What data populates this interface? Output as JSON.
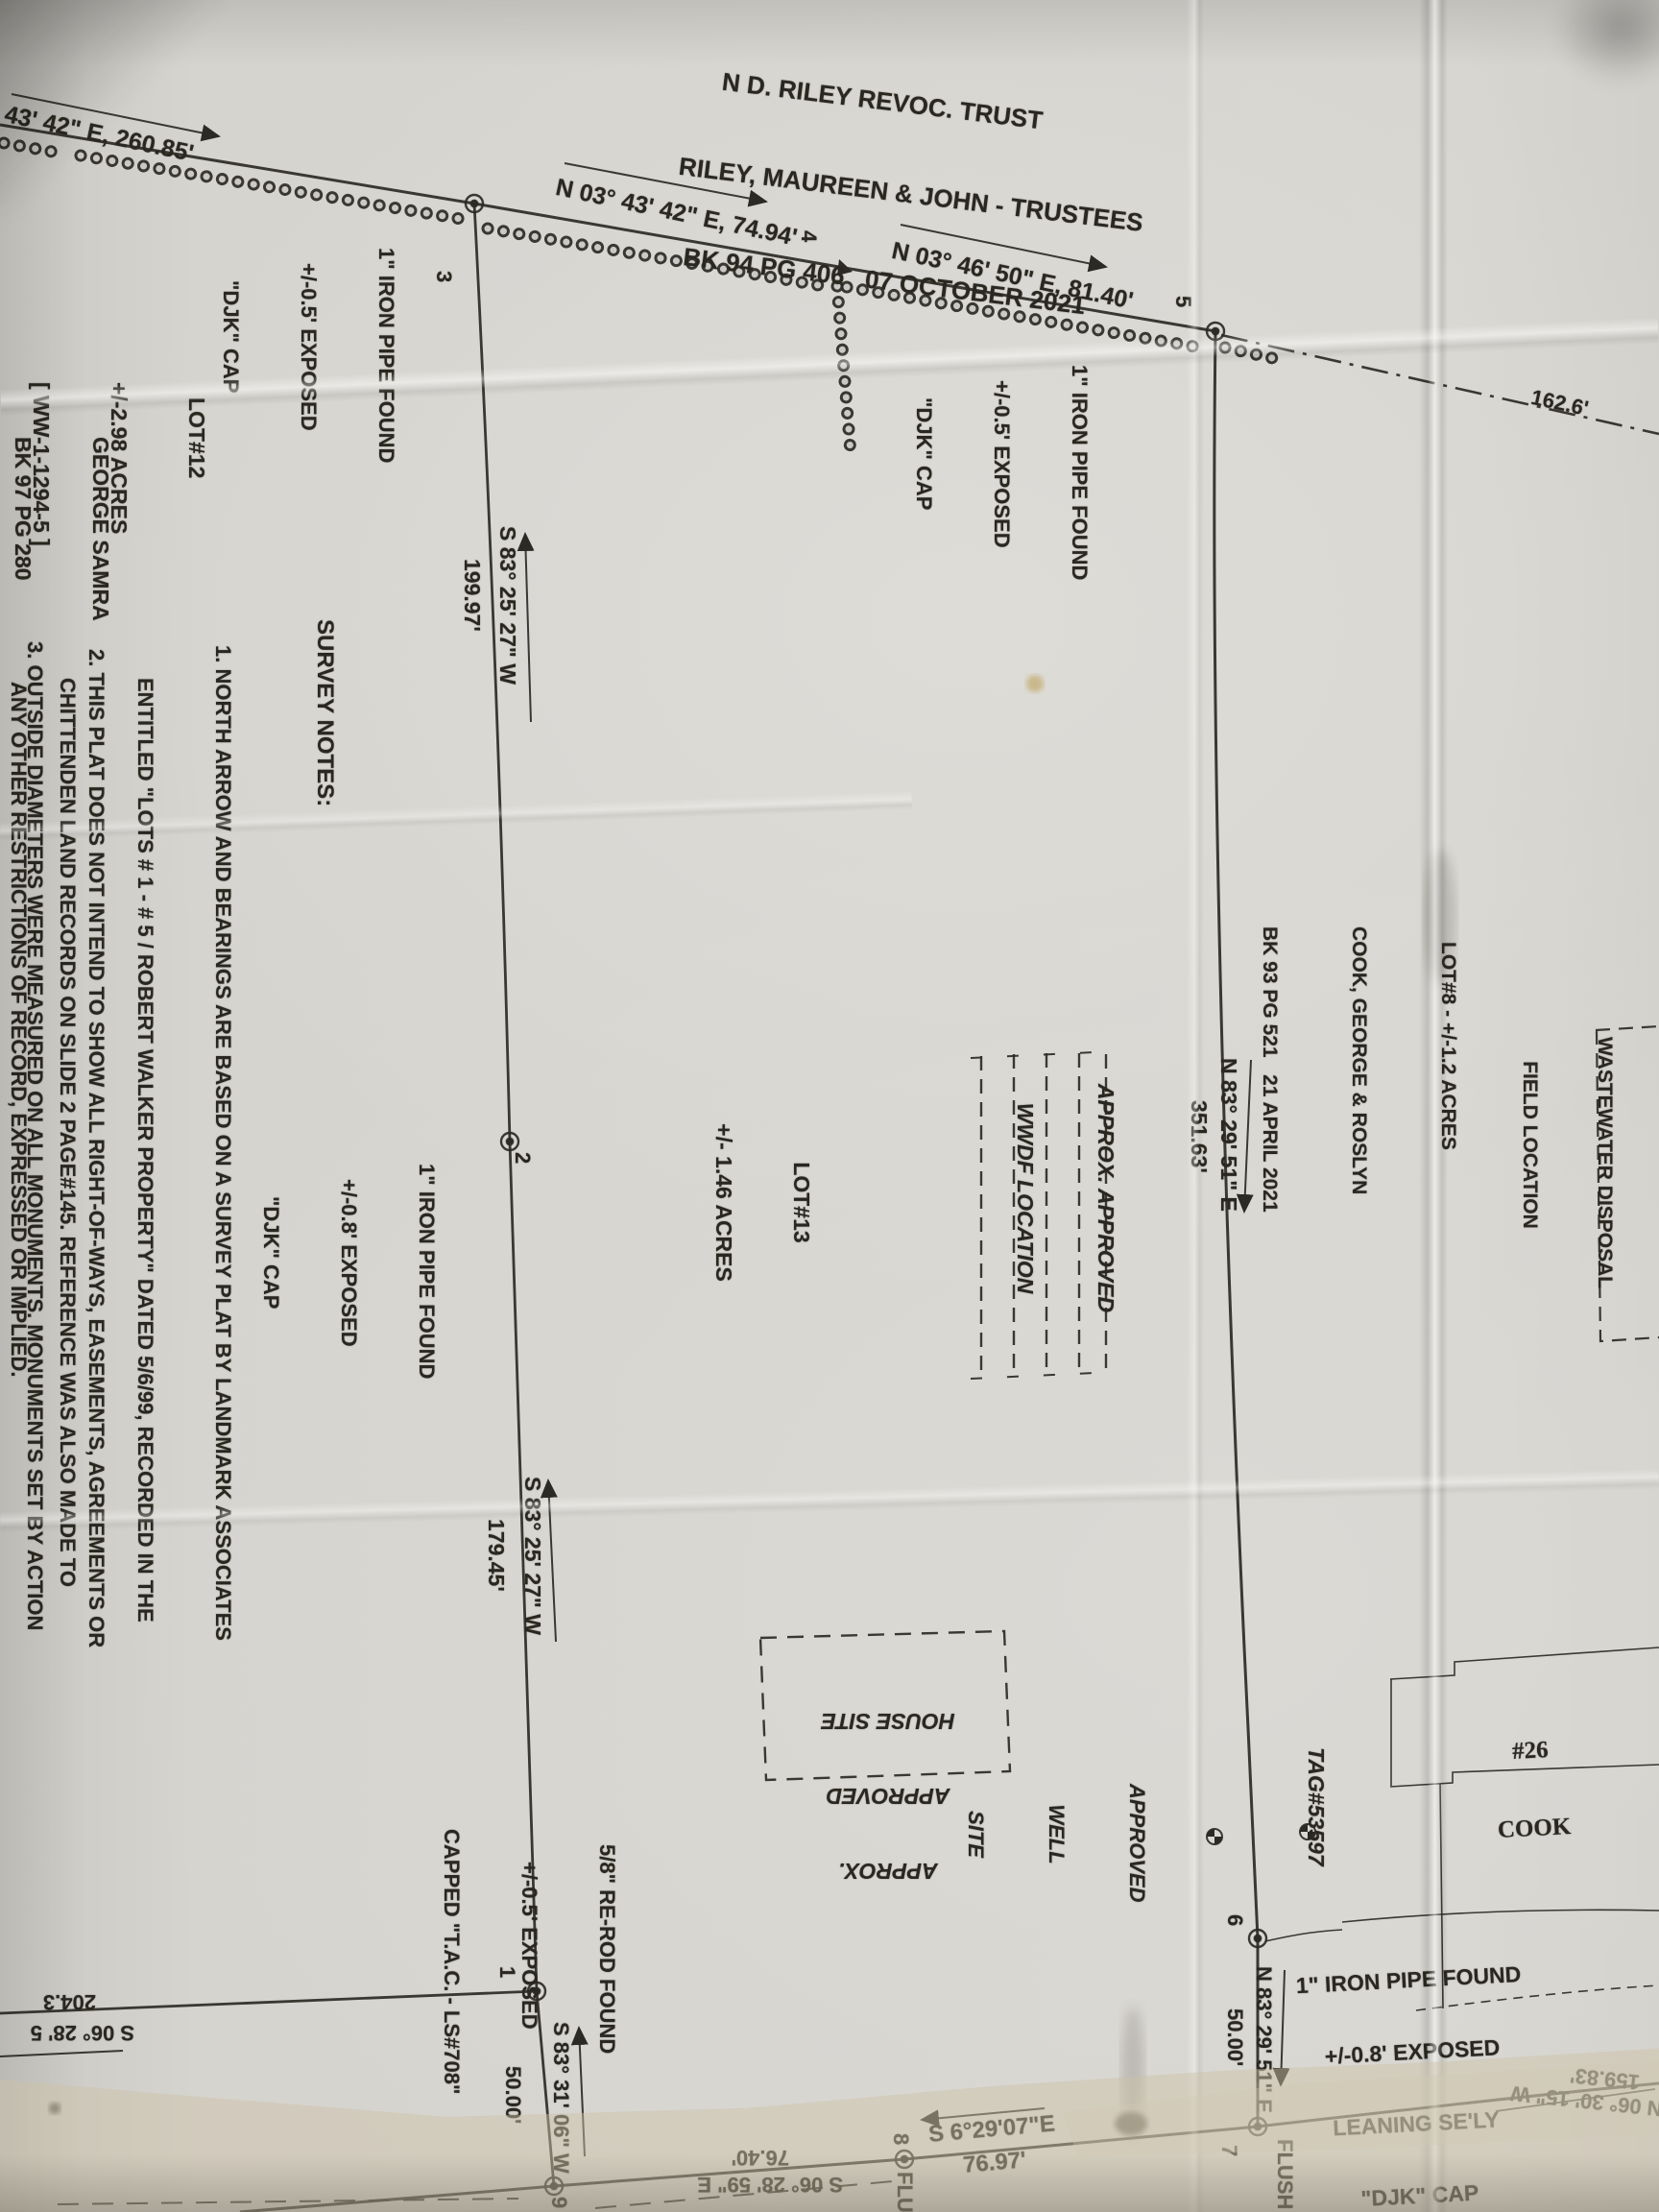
{
  "title": {
    "line1": "N D. RILEY REVOC. TRUST",
    "line2": "RILEY, MAUREEN & JOHN - TRUSTEES",
    "line3": "BK 94 PG 406   07 OCTOBER 2021"
  },
  "bearings": {
    "b260": "43' 42\" E, 260.85'",
    "b7494": "N 03° 43' 42\" E, 74.94'",
    "b8140": "N 03° 46' 50\" E, 81.40'",
    "b1626": "162.6'",
    "b19997_brg": "S 83° 25' 27\" W",
    "b19997_dist": "199.97'",
    "b35163_brg": "N 83° 29' 51\" E",
    "b35163_dist": "351.63'",
    "b17945_brg": "S 83° 25' 27\" W",
    "b17945_dist": "179.45'",
    "b5000e_brg": "N 83° 29' 51\" E",
    "b5000e_dist": "50.00'",
    "b5000w_brg": "S 83° 31' 06\" W",
    "b5000w_dist": "50.00'",
    "b7697_brg": "S 6°29'07\"E",
    "b7697_dist": "76.97'",
    "b7640_brg": "S 06° 28' 59\" E",
    "b7640_dist": "76.40'",
    "b15983_dist": "159.83'",
    "b15983_brg": "N 06° 30' 15\" W",
    "b2043": "204.3",
    "b06285": "S 06° 28' 5"
  },
  "points": {
    "p1": "1",
    "p2": "2",
    "p3": "3",
    "p4": "4",
    "p5": "5",
    "p6": "6",
    "p7": "7",
    "p8": "8",
    "p9": "9"
  },
  "monuments": {
    "ip3": {
      "l1": "1\" IRON PIPE FOUND",
      "l2": "+/-0.5' EXPOSED",
      "l3": "\"DJK\" CAP"
    },
    "ip5": {
      "l1": "1\" IRON PIPE FOUND",
      "l2": "+/-0.5' EXPOSED",
      "l3": "\"DJK\" CAP"
    },
    "ip2": {
      "l1": "1\" IRON PIPE FOUND",
      "l2": "+/-0.8' EXPOSED",
      "l3": "\"DJK\" CAP"
    },
    "ip7": {
      "l1": "1\" IRON PIPE FOUND",
      "l2": "+/-0.8' EXPOSED",
      "l3": "LEANING SE'LY",
      "l4": "\"DJK\" CAP"
    },
    "rerod": {
      "l1": "5/8\" RE-ROD FOUND",
      "l2": "+/-0.5' EXPOSED",
      "l3": "CAPPED \"T.A.C. - LS#708\""
    },
    "flush7": "FLUSH",
    "flush8": "FLU"
  },
  "lots": {
    "lot12": {
      "l1": "LOT#12",
      "l2": "+/-2.98 ACRES",
      "l3": "[ WW-1-1294-5 ]"
    },
    "owner12": {
      "l1": "GEORGE SAMRA",
      "l2": "BK 97 PG 280",
      "l3": "13 AUG. 2024"
    },
    "lot13": {
      "l1": "LOT#13",
      "l2": "+/- 1.46 ACRES"
    },
    "lot8": {
      "l1": "LOT#8 - +/-1.2 ACRES",
      "l2": "COOK, GEORGE & ROSLYN",
      "l3": "BK 93 PG 521   21 APRIL 2021"
    }
  },
  "features": {
    "wwdf": {
      "l1": "APPROX. APPROVED",
      "l2": "WWDF LOCATION"
    },
    "house": {
      "l1": "APPROX.",
      "l2": "APPROVED",
      "l3": "HOUSE SITE"
    },
    "well": {
      "l1": "APPROVED",
      "l2": "WELL",
      "l3": "SITE"
    },
    "tag": "TAG#53597",
    "wastewater": {
      "l1": "WASTEWATER DISPOSAL",
      "l2": "FIELD LOCATION"
    },
    "cook26": {
      "l1": "#26",
      "l2": "COOK"
    }
  },
  "notes": {
    "header": "SURVEY NOTES:",
    "n1": [
      "1. NORTH ARROW AND BEARINGS ARE BASED ON A SURVEY PLAT BY LANDMARK ASSOCIATES",
      "ENTITLED \"LOTS # 1 - # 5 / ROBERT WALKER PROPERTY\" DATED 5/6/99, RECORDED IN THE",
      "CHITTENDEN LAND RECORDS ON SLIDE 2 PAGE#145. REFERENCE WAS ALSO MADE TO",
      "VARIOUS OTHER SURVEYS OF RECORD FOR HE WALKER PROPERTY."
    ],
    "n2": [
      "2. THIS PLAT DOES NOT INTEND TO SHOW ALL RIGHT-OF-WAYS, EASEMENTS, AGREEMENTS OR",
      "ANY OTHER RESTRICTIONS OF RECORD, EXPRESSED OR IMPLIED."
    ],
    "n3": [
      "3. OUTSIDE DIAMETERS WERE MEASURED ON ALL MONUMENTS. MONUMENTS SET BY ACTION",
      "SURVEYING ARE 5/8\" X 30\" RE-RODS, CAPPED \"T.A.C. - L.S.#708 \", SET +/-0.5' EXPOSED UNLESS",
      "OTHERWISE NOTED HEREON."
    ],
    "n4": [
      "4. IT IS THE PROPERTY OWNERS RESP"
    ]
  }
}
